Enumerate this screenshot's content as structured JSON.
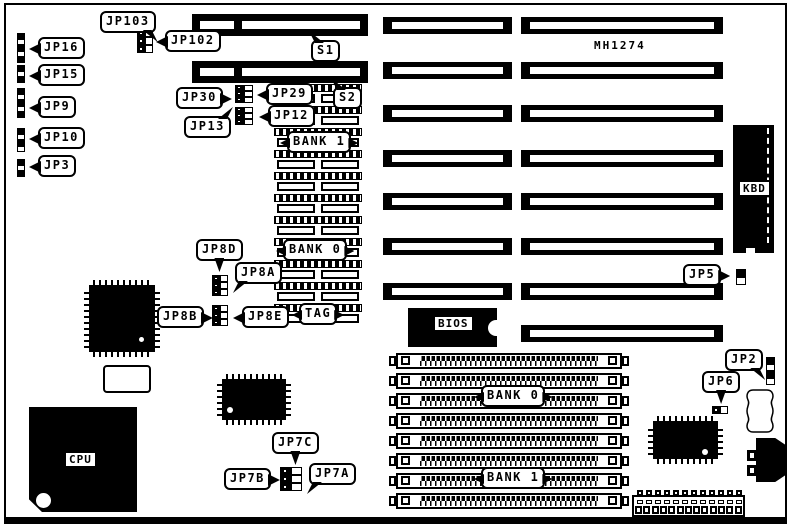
{
  "diagram": {
    "ink_color": "#000000",
    "background_color": "#ffffff"
  },
  "labels": {
    "model": "MH1274",
    "jp103": "JP103",
    "jp102": "JP102",
    "jp16": "JP16",
    "jp15": "JP15",
    "jp9": "JP9",
    "jp10": "JP10",
    "jp3": "JP3",
    "s1": "S1",
    "s2": "S2",
    "jp30": "JP30",
    "jp29": "JP29",
    "jp13": "JP13",
    "jp12": "JP12",
    "bank1_cache": "BANK 1",
    "bank0_cache": "BANK 0",
    "tag": "TAG",
    "jp8d": "JP8D",
    "jp8a": "JP8A",
    "jp8b": "JP8B",
    "jp8e": "JP8E",
    "cpu": "CPU",
    "bios": "BIOS",
    "kbd": "KBD",
    "jp5": "JP5",
    "jp2": "JP2",
    "jp6": "JP6",
    "jp7c": "JP7C",
    "jp7b": "JP7B",
    "jp7a": "JP7A",
    "bank0_simm": "BANK 0",
    "bank1_simm": "BANK 1"
  },
  "board": {
    "model": "MH1274",
    "labeled_slots": [
      "S1",
      "S2"
    ],
    "expansion_slots_left_column": 7,
    "expansion_slots_right_column": 8,
    "simm_sockets_bottom": 8,
    "cache_socket_rows": 11,
    "bottom_connector_positions": 13,
    "jumpers": [
      "JP103",
      "JP102",
      "JP16",
      "JP15",
      "JP9",
      "JP10",
      "JP3",
      "JP30",
      "JP29",
      "JP13",
      "JP12",
      "JP8D",
      "JP8A",
      "JP8B",
      "JP8E",
      "JP7A",
      "JP7B",
      "JP7C",
      "JP6",
      "JP5",
      "JP2"
    ],
    "memory_bank_labels": [
      "BANK 0",
      "BANK 1"
    ],
    "cache_area_labels": [
      "BANK 1",
      "BANK 0",
      "TAG"
    ]
  }
}
